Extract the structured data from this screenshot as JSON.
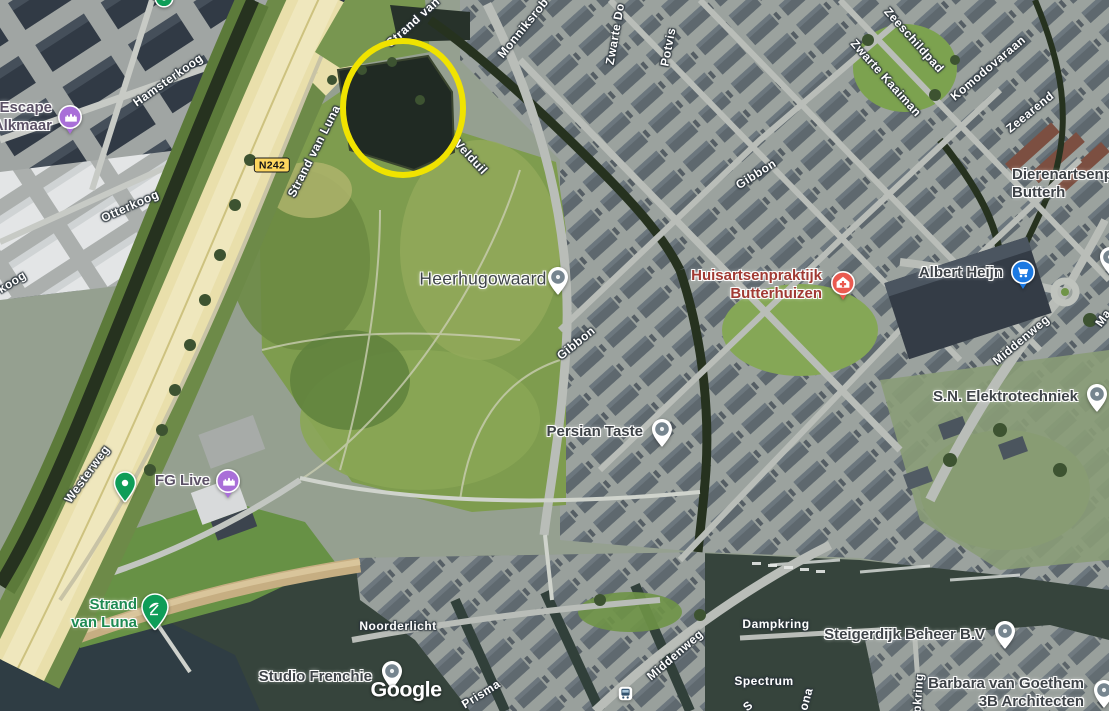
{
  "map_type": "satellite",
  "attribution_logo": "Google",
  "google_logo": {
    "x": 406,
    "y": 690
  },
  "road_badge": {
    "text": "N242",
    "x": 272,
    "y": 165
  },
  "annotation_circle": {
    "cx": 403,
    "cy": 108,
    "rx": 63,
    "ry": 70,
    "color": "#f0e300",
    "stroke_width": 6
  },
  "city_label": {
    "id": "heerhugowaard",
    "text": "Heerhugowaard",
    "x": 483,
    "y": 279,
    "icon": "generic",
    "icon_x": 558,
    "icon_y": 277
  },
  "street_labels": [
    {
      "text": "Hamsterkoog",
      "x": 168,
      "y": 80,
      "rot": -35
    },
    {
      "text": "Otterkoog",
      "x": 130,
      "y": 206,
      "rot": -24
    },
    {
      "text": "koog",
      "x": 12,
      "y": 282,
      "rot": -32
    },
    {
      "text": "Strand van",
      "x": 413,
      "y": 22,
      "rot": -42
    },
    {
      "text": "Strand van Luna",
      "x": 314,
      "y": 151,
      "rot": -63
    },
    {
      "text": "Velduil",
      "x": 471,
      "y": 157,
      "rot": 47
    },
    {
      "text": "Monniksrob",
      "x": 523,
      "y": 28,
      "rot": -51
    },
    {
      "text": "Zwarte Do",
      "x": 615,
      "y": 34,
      "rot": -80
    },
    {
      "text": "Potvis",
      "x": 668,
      "y": 47,
      "rot": -79
    },
    {
      "text": "Gibbon",
      "x": 756,
      "y": 174,
      "rot": -32
    },
    {
      "text": "Zeeschildpad",
      "x": 914,
      "y": 40,
      "rot": 48
    },
    {
      "text": "Zwarte Kaaiman",
      "x": 886,
      "y": 78,
      "rot": 48
    },
    {
      "text": "Komodovaraan",
      "x": 988,
      "y": 68,
      "rot": -40
    },
    {
      "text": "Zeearend",
      "x": 1030,
      "y": 112,
      "rot": -39
    },
    {
      "text": "Gibbon",
      "x": 576,
      "y": 343,
      "rot": -39
    },
    {
      "text": "Westerweg",
      "x": 87,
      "y": 474,
      "rot": -54
    },
    {
      "text": "Middenweg",
      "x": 1021,
      "y": 340,
      "rot": -40
    },
    {
      "text": "Ma",
      "x": 1103,
      "y": 318,
      "rot": -55
    },
    {
      "text": "Noorderlicht",
      "x": 398,
      "y": 626,
      "rot": 0
    },
    {
      "text": "Middenweg",
      "x": 675,
      "y": 655,
      "rot": -41
    },
    {
      "text": "Dampkring",
      "x": 776,
      "y": 624,
      "rot": 0
    },
    {
      "text": "Spectrum",
      "x": 764,
      "y": 681,
      "rot": 0
    },
    {
      "text": "Prisma",
      "x": 481,
      "y": 694,
      "rot": -32
    },
    {
      "text": "pkring",
      "x": 918,
      "y": 693,
      "rot": -86
    },
    {
      "text": "ona",
      "x": 806,
      "y": 699,
      "rot": -75
    },
    {
      "text": "S",
      "x": 748,
      "y": 706,
      "rot": -40
    }
  ],
  "pois": [
    {
      "id": "escape-alkmaar",
      "lines": [
        "Escape",
        "Alkmaar"
      ],
      "x": 52,
      "y": 117,
      "align": "right",
      "color": "attraction",
      "icon": "attraction",
      "icon_x": 70,
      "icon_y": 117
    },
    {
      "id": "fg-live",
      "lines": [
        "FG Live"
      ],
      "x": 210,
      "y": 481,
      "align": "right",
      "color": "attraction",
      "icon": "attraction",
      "icon_x": 228,
      "icon_y": 481
    },
    {
      "id": "huisartsenpraktijk-butterhuizen",
      "lines": [
        "Huisartsenpraktijk",
        "Butterhuizen"
      ],
      "x": 822,
      "y": 285,
      "align": "right",
      "color": "health",
      "icon": "health",
      "icon_x": 843,
      "icon_y": 283
    },
    {
      "id": "albert-heijn",
      "lines": [
        "Albert Heijn"
      ],
      "x": 1003,
      "y": 273,
      "align": "right",
      "color": "default",
      "icon": "shopping",
      "icon_x": 1023,
      "icon_y": 272
    },
    {
      "id": "persian-taste",
      "lines": [
        "Persian Taste"
      ],
      "x": 643,
      "y": 432,
      "align": "right",
      "color": "default",
      "icon": "generic",
      "icon_x": 662,
      "icon_y": 429
    },
    {
      "id": "sn-elektrotechniek",
      "lines": [
        "S.N. Elektrotechniek"
      ],
      "x": 1078,
      "y": 397,
      "align": "right",
      "color": "default",
      "icon": "generic",
      "icon_x": 1097,
      "icon_y": 394
    },
    {
      "id": "dierenartsenpraktijk-butterhuizen",
      "lines": [
        "Dierenartsenpra",
        "Butterh"
      ],
      "x": 1012,
      "y": 184,
      "align": "left",
      "color": "default",
      "icon": null
    },
    {
      "id": "strand-van-luna",
      "lines": [
        "Strand",
        "van Luna"
      ],
      "x": 137,
      "y": 614,
      "align": "right",
      "color": "nature",
      "icon": "beach",
      "icon_x": 155,
      "icon_y": 607
    },
    {
      "id": "studio-frenchie",
      "lines": [
        "Studio Frenchie"
      ],
      "x": 372,
      "y": 677,
      "align": "right",
      "color": "default",
      "icon": "generic",
      "icon_x": 392,
      "icon_y": 671
    },
    {
      "id": "steigerdijk-beheer",
      "lines": [
        "Steigerdijk Beheer B.V"
      ],
      "x": 985,
      "y": 635,
      "align": "right",
      "color": "default",
      "icon": "generic",
      "icon_x": 1005,
      "icon_y": 631
    },
    {
      "id": "barbara-van-goethem-3b-architecten",
      "lines": [
        "Barbara van Goethem",
        "3B Architecten"
      ],
      "x": 1084,
      "y": 693,
      "align": "right",
      "color": "default",
      "icon": "generic",
      "icon_x": 1104,
      "icon_y": 690
    }
  ],
  "standalone_icons": [
    {
      "id": "park-pin",
      "type": "parkdot",
      "x": 125,
      "y": 483
    },
    {
      "id": "bus-stop",
      "type": "bus",
      "x": 625,
      "y": 693
    },
    {
      "id": "pin-fragment-top",
      "type": "tealfrag",
      "x": 164,
      "y": -2
    },
    {
      "id": "pin-fragment-right",
      "type": "generic",
      "x": 1110,
      "y": 257
    }
  ],
  "colors": {
    "pin_generic": "#76858f",
    "pin_attraction": "#a96fd8",
    "pin_health": "#ea5a50",
    "pin_shopping": "#1b79e2",
    "pin_nature": "#0f9d58",
    "street_text": "#ffffff",
    "annotation": "#f0e300"
  }
}
